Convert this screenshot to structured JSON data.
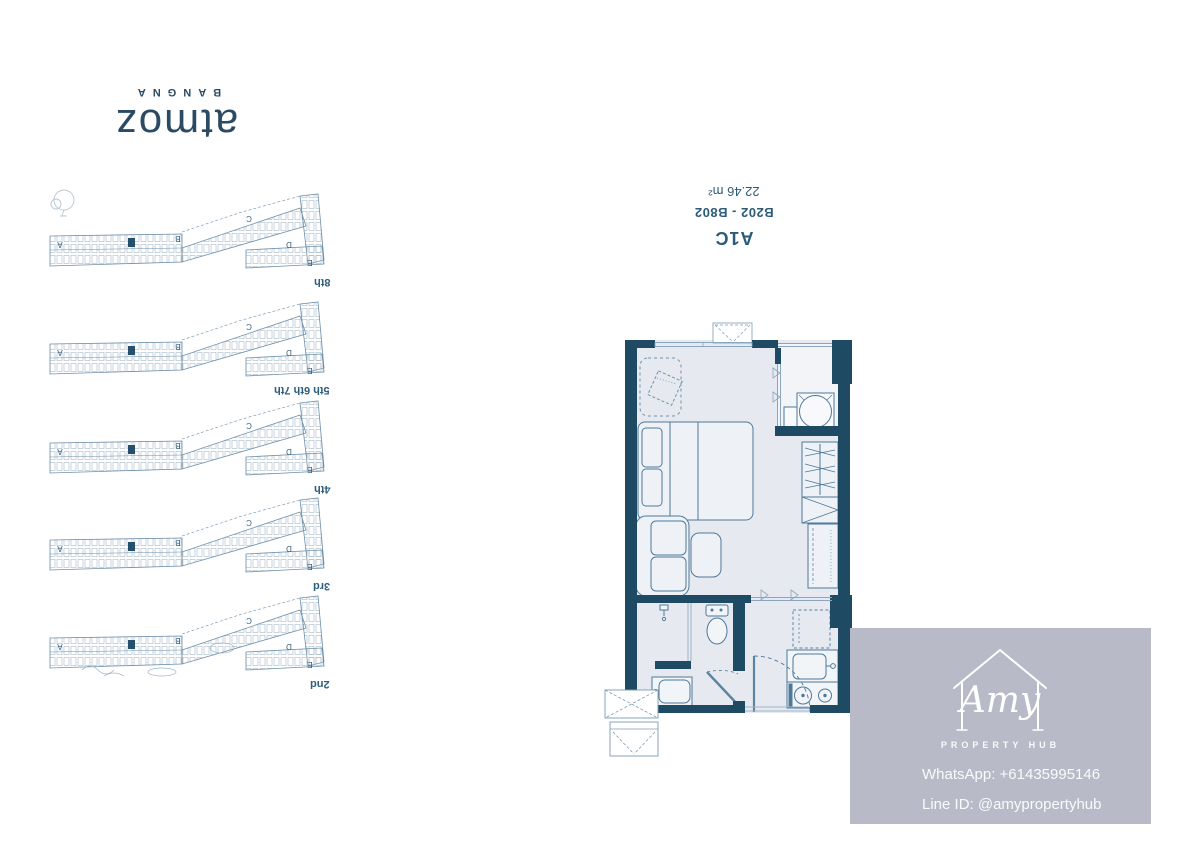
{
  "brand": {
    "name": "atmoz",
    "subtitle": "BANGNA"
  },
  "unit": {
    "type": "A1C",
    "rooms": "B202 - B802",
    "area": "22.46 m²"
  },
  "floor_plates": {
    "section_labels": [
      "A",
      "B",
      "C",
      "D",
      "E"
    ],
    "floors": [
      {
        "label": "8th"
      },
      {
        "label": "5th 6th 7th"
      },
      {
        "label": "4th"
      },
      {
        "label": "3rd"
      },
      {
        "label": "2nd"
      }
    ]
  },
  "watermark": {
    "logo_name": "Amy",
    "logo_subtitle": "PROPERTY HUB",
    "whatsapp": "WhatsApp: +61435995146",
    "line_id": "Line ID: @amypropertyhub"
  },
  "colors": {
    "wall": "#1e4a64",
    "floor": "#e6eaf0",
    "balcony_floor": "#f2f4f8",
    "furniture_stroke": "#4f7899",
    "accent_text": "#2c5b79",
    "watermark_bg": "#b9bac8"
  }
}
